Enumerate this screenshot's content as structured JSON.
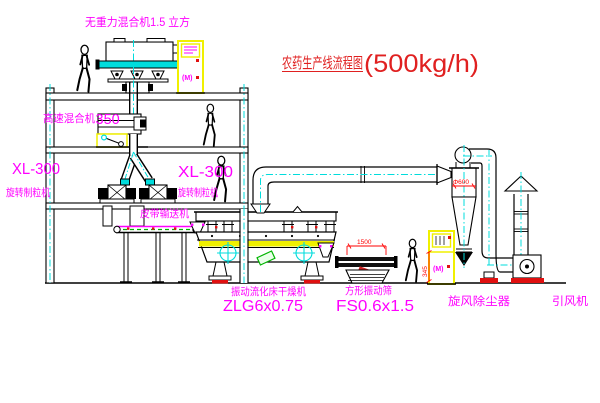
{
  "title": {
    "name": "农药生产线流程图",
    "capacity": "(500kg/h)"
  },
  "labels": {
    "gravity_mixer": "无重力混合机1.5 立方",
    "high_speed_mixer": "高速混合机",
    "high_speed_mixer_size": "350",
    "granulator_model": "XL-300",
    "granulator_name": "旋转制粒机",
    "belt_conveyor": "皮带输送机",
    "dryer_name": "振动流化床干燥机",
    "dryer_model": "ZLG6x0.75",
    "screen_name": "方形振动筛",
    "screen_model": "FS0.6x1.5",
    "cyclone_name": "旋风除尘器",
    "fan_name": "引风机"
  },
  "dimensions": {
    "cyclone_diameter": "Φ600",
    "screen_length": "1500",
    "screen_height": "345"
  },
  "control_cabinet": {
    "display": "(M)"
  },
  "colors": {
    "line": "#000000",
    "centerline": "#00dcdc",
    "label": "#ff00ff",
    "title": "#e02020",
    "dimension": "#ff0000",
    "cabinet": "#f0f000",
    "conveyor_belt": "#00b400"
  }
}
